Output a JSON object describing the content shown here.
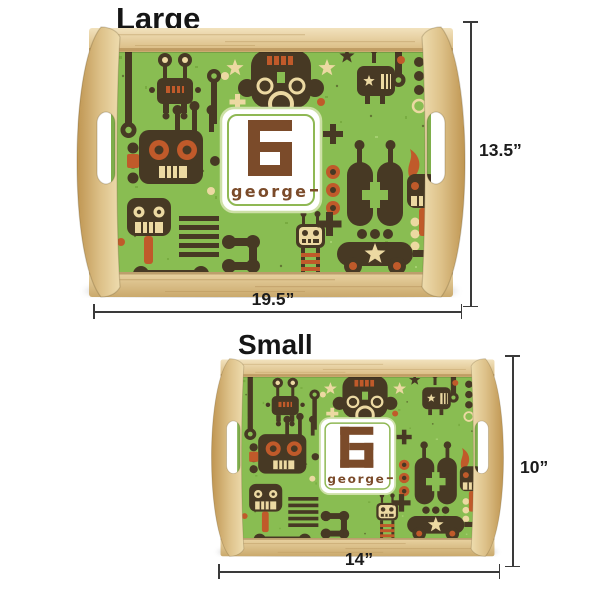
{
  "monogram": {
    "initial": "G",
    "name": "george"
  },
  "sizes": {
    "large": {
      "label": "Large",
      "height": "13.5”",
      "width": "19.5”"
    },
    "small": {
      "label": "Small",
      "height": "10”",
      "width": "14”"
    }
  },
  "colors": {
    "pattern_green": "#89bd52",
    "robot_brown": "#473924",
    "accent_cream": "#ecd9a2",
    "accent_orange": "#c05a2a",
    "wood_light": "#eedcae",
    "wood_dark": "#bf9551",
    "monogram_brown": "#7b4b2a",
    "card_border_green": "#8fb854",
    "dimension_line": "#3a3a3a"
  }
}
